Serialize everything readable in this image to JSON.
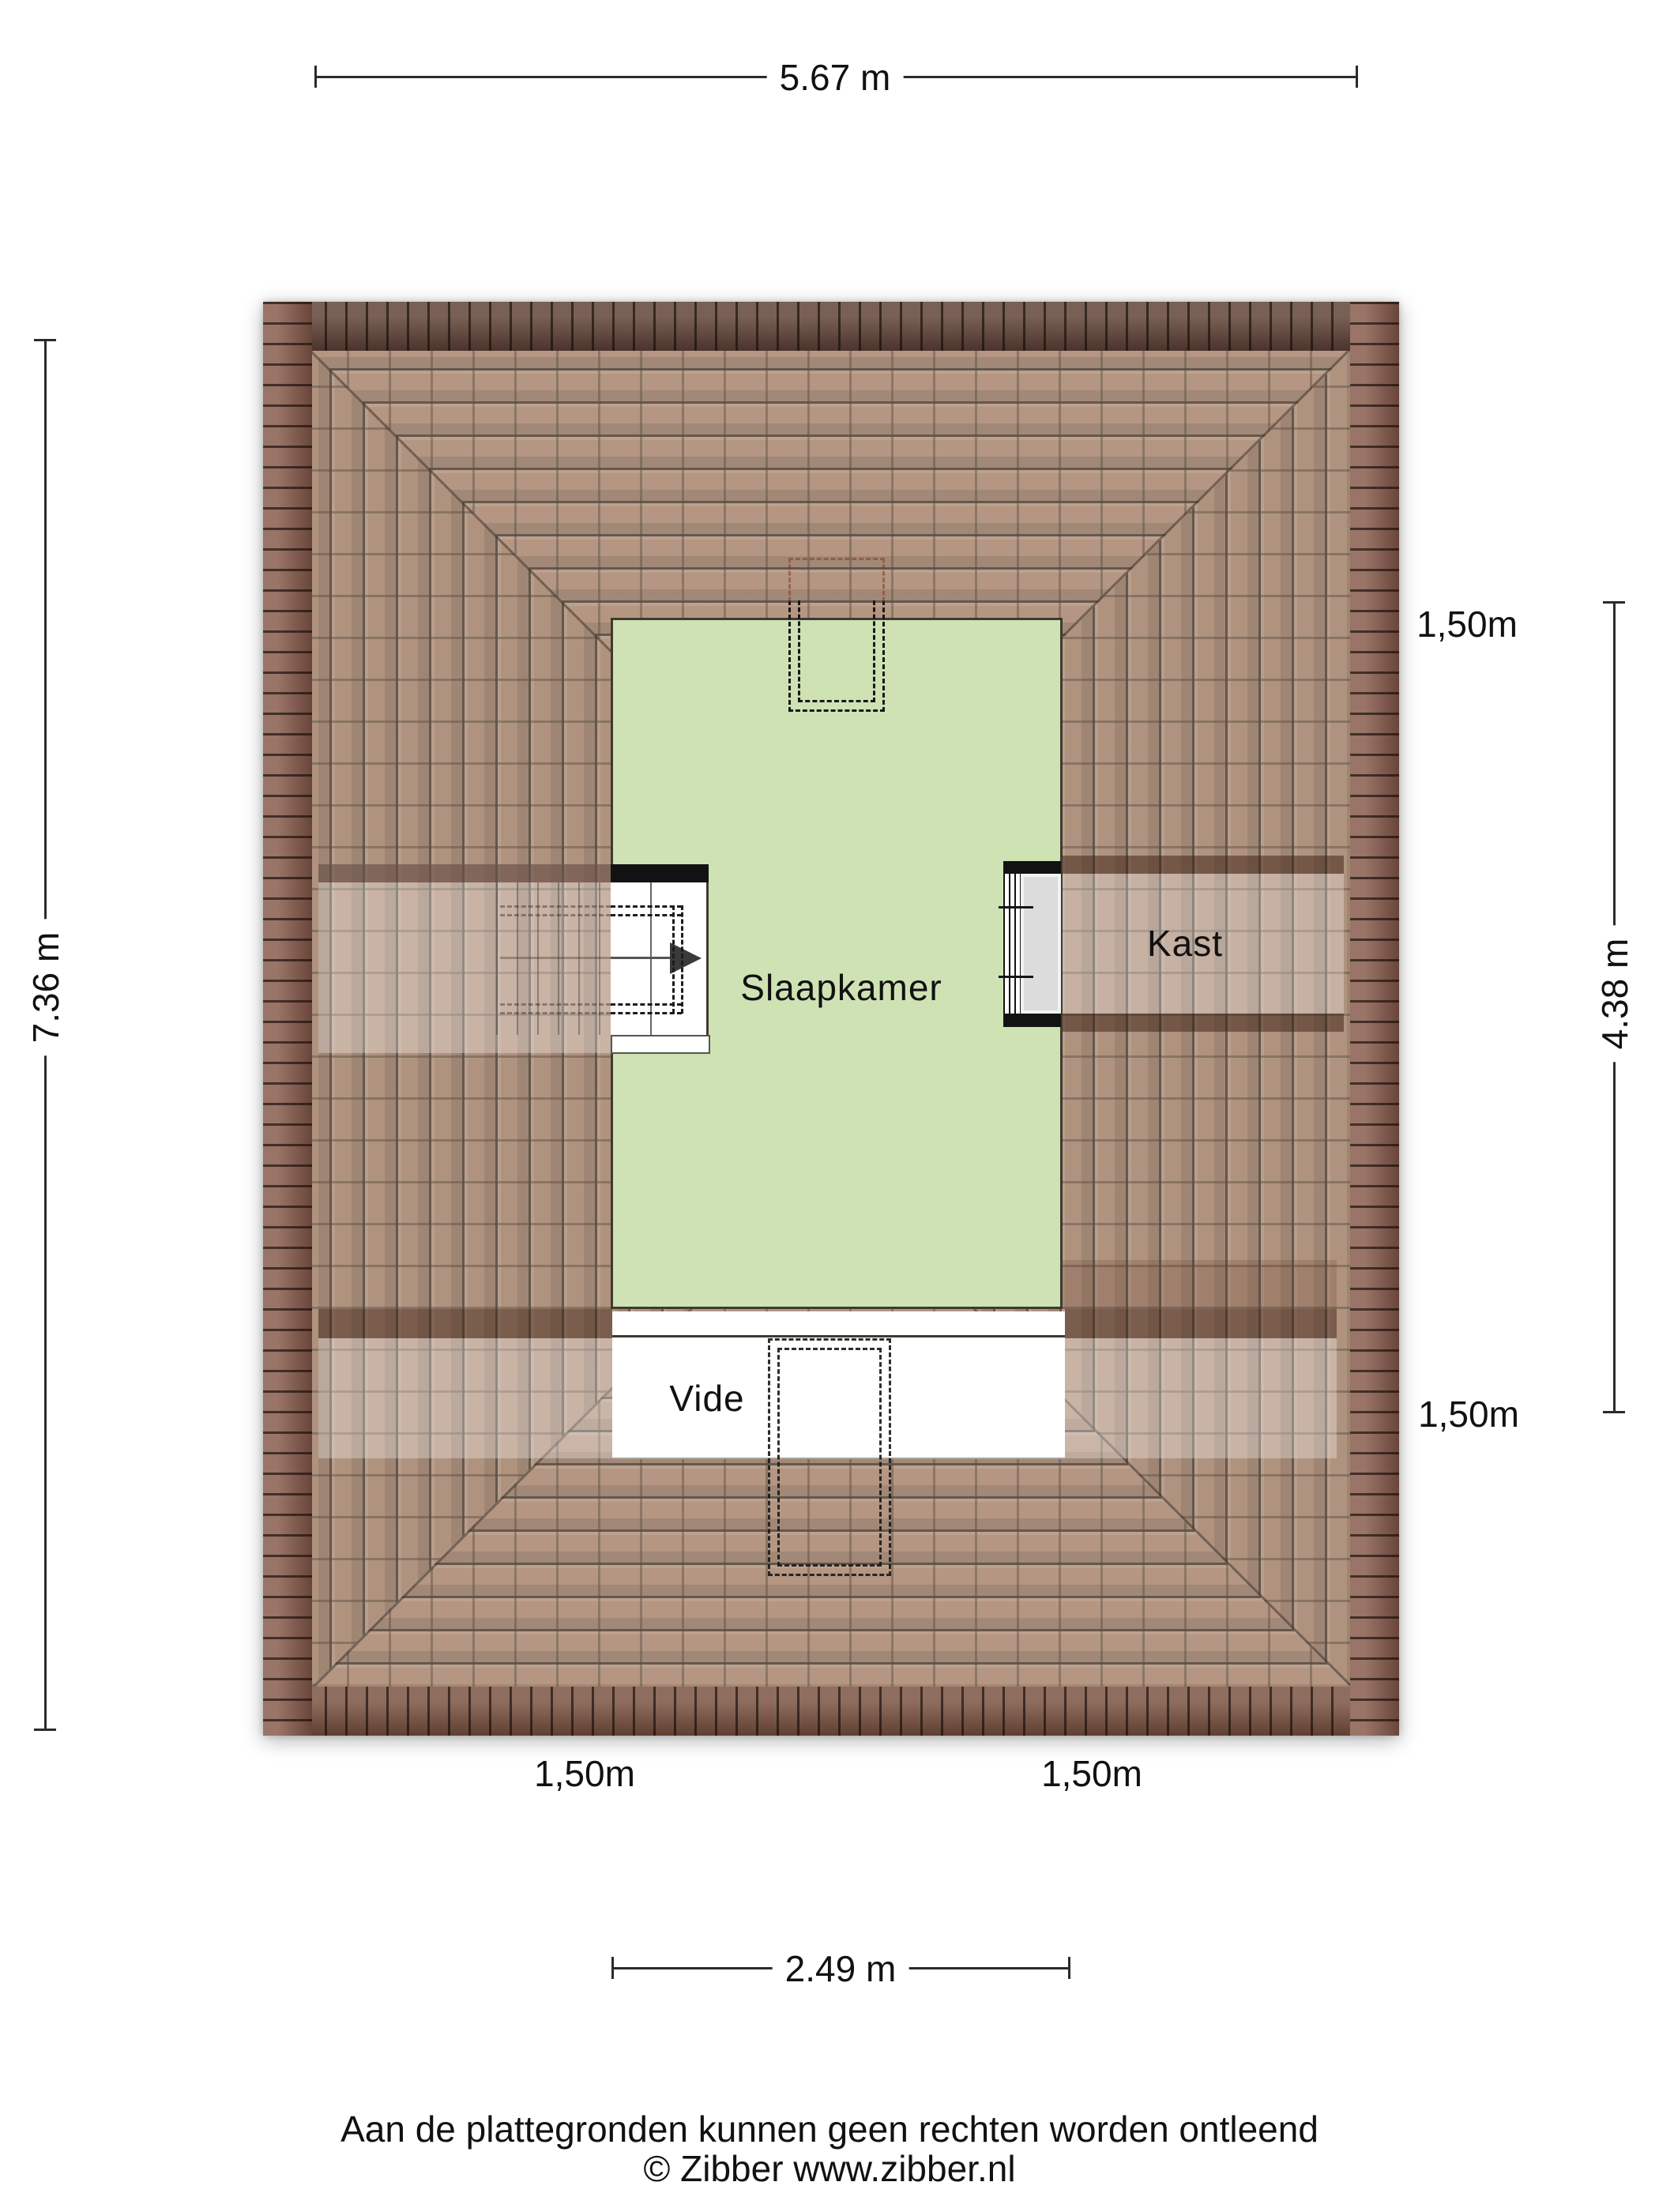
{
  "page": {
    "background": "#ffffff"
  },
  "floorplan": {
    "rooms": {
      "slaapkamer": {
        "label": "Slaapkamer"
      },
      "kast": {
        "label": "Kast"
      },
      "vide": {
        "label": "Vide"
      }
    },
    "colors": {
      "room_fill": "#cfe2b4",
      "roof_field": "#a98770",
      "roof_eave": "#7a5140",
      "wall_black": "#141414",
      "window_gray": "#dcdcdc"
    },
    "icons": {
      "stair_direction": "arrow-right"
    }
  },
  "dimensions": {
    "top": {
      "label": "5.67 m"
    },
    "left": {
      "label": "7.36 m"
    },
    "right": {
      "label": "4.38 m"
    },
    "bottom": {
      "label": "2.49 m"
    },
    "clearance": {
      "right_top": "1,50m",
      "right_bottom": "1,50m",
      "bottom_left": "1,50m",
      "bottom_right": "1,50m"
    }
  },
  "footer": {
    "disclaimer": "Aan de plattegronden kunnen geen rechten worden ontleend",
    "credit": "© Zibber www.zibber.nl"
  }
}
